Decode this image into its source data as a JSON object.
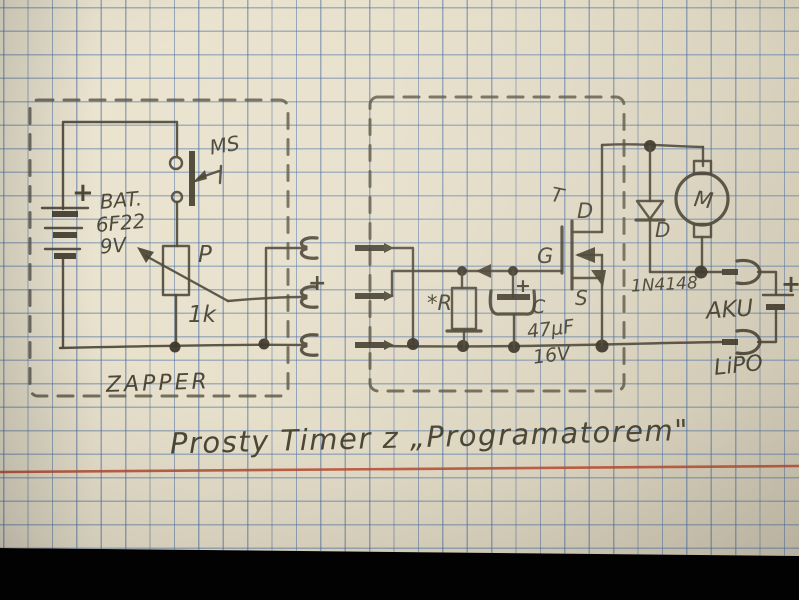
{
  "title": "Prosty Timer z „Programatorem\"",
  "zapper_box": {
    "label": "ZAPPER",
    "battery": {
      "plus": "+",
      "name": "BAT.",
      "model": "6F22",
      "voltage": "9V"
    },
    "switch_label": "MS",
    "potentiometer": {
      "label": "P",
      "value": "1k"
    }
  },
  "connectors": {
    "plus": "+"
  },
  "timer_box": {
    "resistor_label": "*R",
    "capacitor": {
      "plus": "+",
      "label": "C",
      "value": "47µF",
      "voltage": "16V"
    },
    "mosfet": {
      "label": "T",
      "drain": "D",
      "gate": "G",
      "source": "S"
    },
    "diode": {
      "label": "D",
      "part": "1N4148"
    }
  },
  "motor": {
    "label": "M"
  },
  "aku": {
    "plus": "+",
    "label": "AKU",
    "type": "LiPO"
  },
  "colors": {
    "paper": "#e7e0cb",
    "grid_blue": "#7d9ec4",
    "pencil": "#4a4435",
    "margin_red": "#b84a31",
    "photo_background": "#000000"
  }
}
